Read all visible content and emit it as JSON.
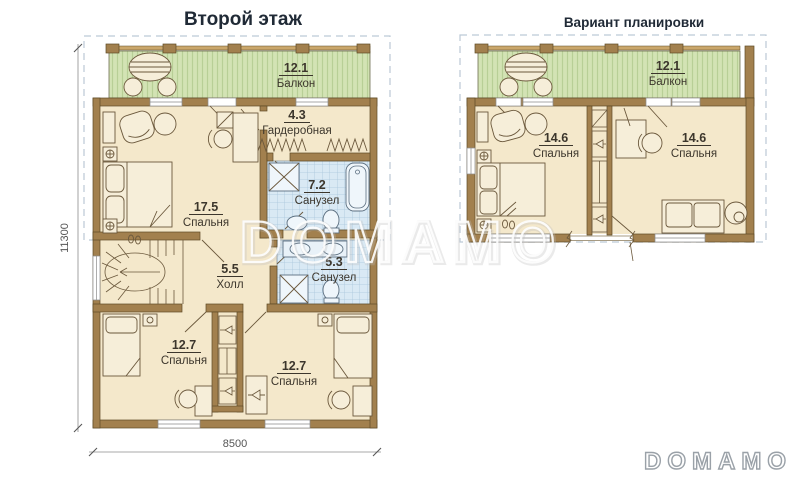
{
  "titles": {
    "left_plan": "Второй этаж",
    "right_plan": "Вариант планировки"
  },
  "left_plan": {
    "balcony": {
      "area": "12.1",
      "name": "Балкон"
    },
    "bedroom_main": {
      "area": "17.5",
      "name": "Спальня"
    },
    "wardrobe": {
      "area": "4.3",
      "name": "Гардеробная"
    },
    "bathroom_big": {
      "area": "7.2",
      "name": "Санузел"
    },
    "hall": {
      "area": "5.5",
      "name": "Холл"
    },
    "bathroom_small": {
      "area": "5.3",
      "name": "Санузел"
    },
    "bedroom_left": {
      "area": "12.7",
      "name": "Спальня"
    },
    "bedroom_right": {
      "area": "12.7",
      "name": "Спальня"
    }
  },
  "right_plan": {
    "balcony": {
      "area": "12.1",
      "name": "Балкон"
    },
    "bedroom_left": {
      "area": "14.6",
      "name": "Спальня"
    },
    "bedroom_right": {
      "area": "14.6",
      "name": "Спальня"
    }
  },
  "dimensions": {
    "vertical": "11300",
    "horizontal": "8500"
  },
  "watermarks": {
    "center": "DOMAMO",
    "corner": "DOMAMO"
  },
  "colors": {
    "wall": "#a2804e",
    "wall_outline": "#5e4a26",
    "floor": "#f4e8cb",
    "balcony": "#d3e3b4",
    "balcony_stripe": "#b8cf96",
    "bathroom_tile": "#d9e9f4",
    "tile_grid": "#a9c7dd",
    "label_text": "#3c362c",
    "title_text": "#202a36",
    "dimension": "#6f6f6f",
    "boundary_dash": "#bcc9d6"
  }
}
